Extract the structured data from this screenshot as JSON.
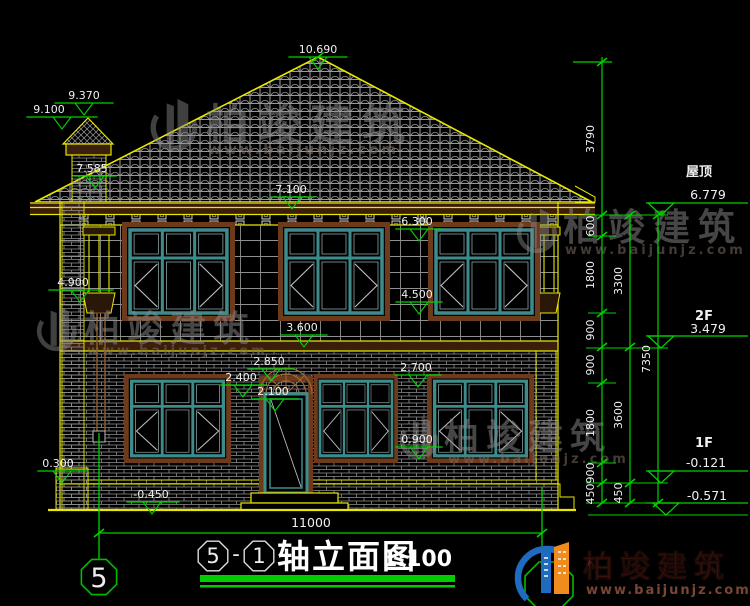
{
  "title": {
    "axis_start": "5",
    "separator": "-",
    "axis_end": "1",
    "name": "轴立面图",
    "scale": "1:100"
  },
  "axis": {
    "left_bubble": "5"
  },
  "dims": {
    "overall_width": "11000",
    "chain_inner": [
      "3790",
      "600",
      "1800",
      "900",
      "900",
      "1800",
      "900",
      "450"
    ],
    "chain_mid": [
      "3300",
      "3600",
      "450"
    ],
    "chain_outer": [
      "7350"
    ]
  },
  "levels_left": {
    "roof_peak": "10.690",
    "chimney_cap_top": "9.370",
    "chimney_cap_base": "9.100",
    "roof_at_chimney": "7.585",
    "eave_soffit": "7.100",
    "window2f_head": "6.300",
    "pilaster_base": "4.900",
    "window2f_sill": "4.500",
    "floor_band": "3.600",
    "door_arch_top": "2.850",
    "window1f_head": "2.400",
    "door_head": "2.100",
    "window1f_head_right": "2.700",
    "window1f_sill": "0.900",
    "plinth_top": "0.300",
    "outdoor_ground": "-0.450"
  },
  "levels_right": {
    "roof_label": "屋顶",
    "roof_value": "6.779",
    "floor2_label": "2F",
    "floor2_value": "3.479",
    "floor1_label": "1F",
    "floor1_value": "-0.121",
    "ground_value": "-0.571"
  },
  "branding": {
    "watermark_text": "柏竣建筑",
    "watermark_url": "www.baijunjz.com",
    "logo_text": "柏竣建筑",
    "logo_url": "www.baijunjz.com"
  },
  "colors": {
    "dim_green": "#00d400",
    "line_yellow": "#e8e800",
    "frame_teal": "#3d8c8c",
    "trim_brown": "#6e3a1c",
    "logo_blue": "#1f6bbf",
    "logo_orange": "#f08c1e",
    "logo_text_red": "#641f12"
  }
}
